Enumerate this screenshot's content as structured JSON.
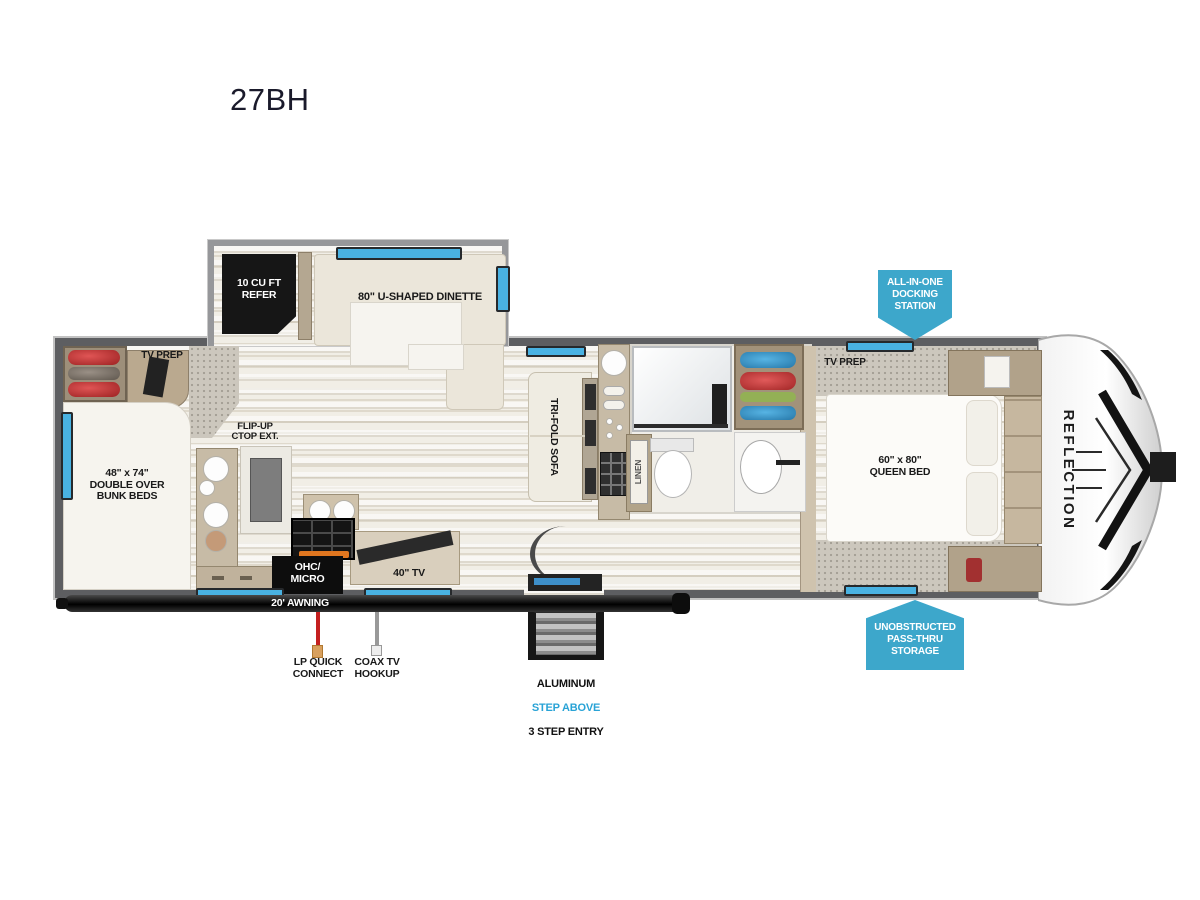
{
  "title": "27BH",
  "colors": {
    "badge_blue": "#3da7cb",
    "window_blue": "#49b2e2",
    "step_above_cyan": "#29a3d6",
    "lp_red": "#c41f1f",
    "wall_gray": "#5d5e61"
  },
  "badges": {
    "docking": "ALL-IN-ONE\nDOCKING\nSTATION",
    "storage": "UNOBSTRUCTED\nPASS-THRU\nSTORAGE"
  },
  "labels": {
    "refer": "10 CU FT\nREFER",
    "dinette": "80\" U-SHAPED DINETTE",
    "tv_prep_left": "TV PREP",
    "tv_prep_bedroom": "TV PREP",
    "bunks": "48\" x 74\"\nDOUBLE OVER\nBUNK BEDS",
    "flip_up": "FLIP-UP\nCTOP EXT.",
    "sofa": "TRI-FOLD SOFA",
    "linen": "LINEN",
    "ohc_micro": "OHC/\nMICRO",
    "tv_40": "40\" TV",
    "queen_bed": "60\" x 80\"\nQUEEN BED",
    "awning": "20' AWNING",
    "lp_quick": "LP QUICK\nCONNECT",
    "coax": "COAX TV\nHOOKUP",
    "entry_line1": "ALUMINUM",
    "entry_line2": "STEP ABOVE",
    "entry_line3": "3 STEP ENTRY",
    "brand": "REFLECTION"
  }
}
